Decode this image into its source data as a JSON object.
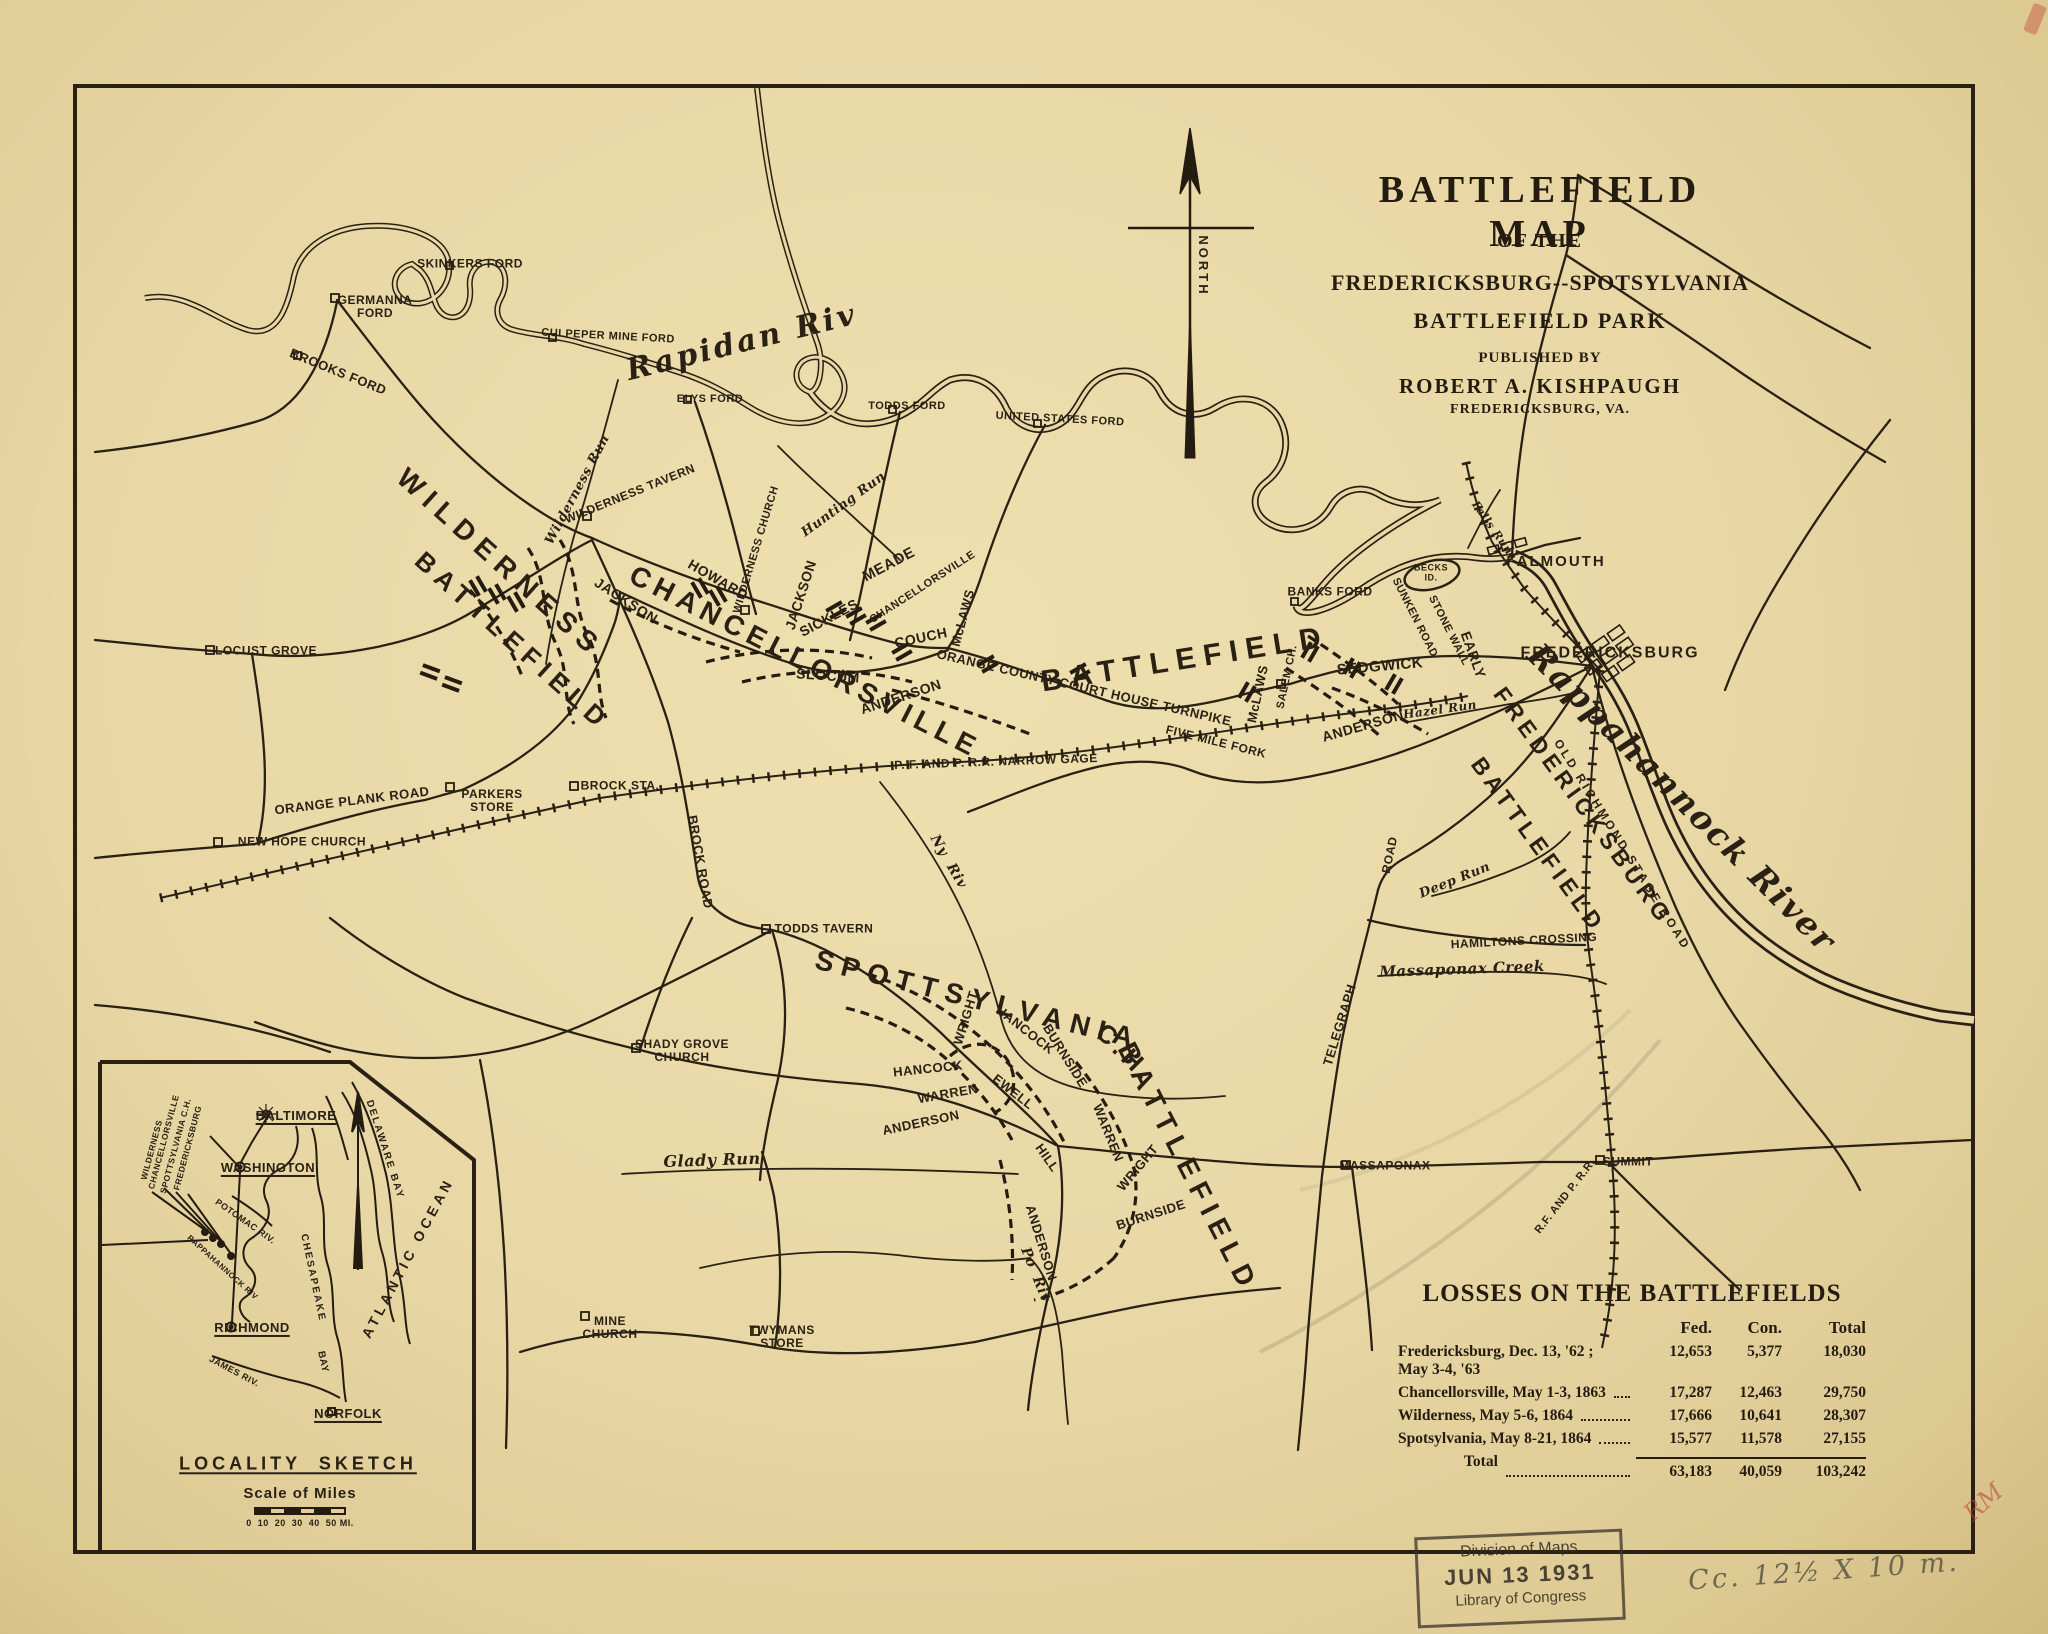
{
  "title_block": {
    "line1": "BATTLEFIELD MAP",
    "line2": "OF THE",
    "line3": "FREDERICKSBURG--SPOTSYLVANIA",
    "line4": "BATTLEFIELD PARK",
    "published_by": "PUBLISHED BY",
    "publisher": "ROBERT A. KISHPAUGH",
    "publisher_city": "FREDERICKSBURG, VA."
  },
  "north_arrow": {
    "label": "NORTH"
  },
  "losses_table": {
    "title": "LOSSES ON THE BATTLEFIELDS",
    "columns": [
      "Fed.",
      "Con.",
      "Total"
    ],
    "rows": [
      {
        "name": "Fredericksburg, Dec. 13, '62 ; May 3-4, '63",
        "fed": "12,653",
        "con": "5,377",
        "total": "18,030"
      },
      {
        "name": "Chancellorsville, May 1-3, 1863",
        "fed": "17,287",
        "con": "12,463",
        "total": "29,750"
      },
      {
        "name": "Wilderness, May 5-6, 1864",
        "fed": "17,666",
        "con": "10,641",
        "total": "28,307"
      },
      {
        "name": "Spotsylvania, May 8-21, 1864",
        "fed": "15,577",
        "con": "11,578",
        "total": "27,155"
      }
    ],
    "total_row": {
      "name": "Total",
      "fed": "63,183",
      "con": "40,059",
      "total": "103,242"
    }
  },
  "stamp": {
    "line1": "Division of Maps",
    "line2": "JUN 13 1931",
    "line3": "Library of Congress"
  },
  "annotations": {
    "pencil_note": "Cc. 12½ X 10 m.",
    "red_mark": "RM"
  },
  "colors": {
    "ink": "#2a2114",
    "paper": "#e9d8a6",
    "stamp": "#38322866",
    "pencil": "#6e6750",
    "red": "#b93e32"
  },
  "map_labels": [
    {
      "t": "SKINKERS FORD",
      "x": 470,
      "y": 264,
      "r": 0,
      "c": "pl",
      "fs": 12,
      "n": "label-skinkers-ford"
    },
    {
      "t": "GERMANNA\nFORD",
      "x": 375,
      "y": 307,
      "r": 0,
      "c": "pl",
      "fs": 12,
      "n": "label-germanna-ford"
    },
    {
      "t": "BROOKS FORD",
      "x": 338,
      "y": 372,
      "r": 22,
      "c": "pl",
      "fs": 13,
      "n": "label-brooks-ford"
    },
    {
      "t": "CULPEPER MINE FORD",
      "x": 608,
      "y": 337,
      "r": 3,
      "c": "pl",
      "fs": 11,
      "n": "label-culpeper-mine-ford"
    },
    {
      "t": "ELYS FORD",
      "x": 710,
      "y": 400,
      "r": 0,
      "c": "pl",
      "fs": 11,
      "n": "label-elys-ford"
    },
    {
      "t": "TODDS FORD",
      "x": 907,
      "y": 407,
      "r": 0,
      "c": "pl",
      "fs": 11,
      "n": "label-todds-ford"
    },
    {
      "t": "UNITED STATES FORD",
      "x": 1060,
      "y": 420,
      "r": 3,
      "c": "pl",
      "fs": 11,
      "n": "label-united-states-ford"
    },
    {
      "t": "BANKS FORD",
      "x": 1330,
      "y": 592,
      "r": 0,
      "c": "pl",
      "fs": 12,
      "n": "label-banks-ford"
    },
    {
      "t": "Rapidan Riv",
      "x": 742,
      "y": 343,
      "r": -14,
      "c": "scr",
      "fs": 30,
      "ls": 3,
      "n": "label-rapidan-river"
    },
    {
      "t": "Rappahannock River",
      "x": 1682,
      "y": 798,
      "r": 45,
      "c": "scr",
      "fs": 33,
      "ls": 2,
      "n": "label-rappahannock-river"
    },
    {
      "t": "Wilderness Run",
      "x": 578,
      "y": 490,
      "r": -62,
      "c": "scr",
      "fs": 13,
      "n": "label-wilderness-run"
    },
    {
      "t": "Hunting Run",
      "x": 844,
      "y": 505,
      "r": -36,
      "c": "scr",
      "fs": 13,
      "n": "label-hunting-run"
    },
    {
      "t": "Falls Run",
      "x": 1492,
      "y": 528,
      "r": 55,
      "c": "scr",
      "fs": 11,
      "n": "label-falls-run"
    },
    {
      "t": "Ny  Riv",
      "x": 948,
      "y": 862,
      "r": 60,
      "c": "scr",
      "fs": 14,
      "n": "label-ny-river"
    },
    {
      "t": "Po  Riv",
      "x": 1035,
      "y": 1275,
      "r": 68,
      "c": "scr",
      "fs": 14,
      "n": "label-po-river"
    },
    {
      "t": "Glady Run",
      "x": 712,
      "y": 1160,
      "r": -2,
      "c": "scr",
      "fs": 16,
      "n": "label-glady-run"
    },
    {
      "t": "Massaponax Creek",
      "x": 1462,
      "y": 969,
      "r": -2,
      "c": "scr",
      "fs": 15,
      "n": "label-massaponax-creek"
    },
    {
      "t": "Deep Run",
      "x": 1455,
      "y": 881,
      "r": -22,
      "c": "scr",
      "fs": 13,
      "n": "label-deep-run"
    },
    {
      "t": "Hazel Run",
      "x": 1440,
      "y": 710,
      "r": -8,
      "c": "scr",
      "fs": 12,
      "n": "label-hazel-run"
    },
    {
      "t": "WILDERNESS",
      "x": 500,
      "y": 563,
      "r": 42,
      "c": "big",
      "fs": 28,
      "ls": 8,
      "n": "label-wilderness-battlefield-1"
    },
    {
      "t": "BATTLEFIELD",
      "x": 513,
      "y": 641,
      "r": 42,
      "c": "big",
      "fs": 26,
      "ls": 7,
      "n": "label-wilderness-battlefield-2"
    },
    {
      "t": "CHANCELLORSVILLE",
      "x": 805,
      "y": 662,
      "r": 27,
      "c": "big",
      "fs": 28,
      "ls": 6,
      "n": "label-chancellorsville-big"
    },
    {
      "t": "BATTLEFIELD",
      "x": 1185,
      "y": 660,
      "r": -9,
      "c": "big",
      "fs": 30,
      "ls": 8,
      "n": "label-chancellorsville-battlefield"
    },
    {
      "t": "FREDERICKSBURG",
      "x": 1583,
      "y": 806,
      "r": 54,
      "c": "big",
      "fs": 23,
      "ls": 5,
      "n": "label-fredericksburg-battlefield-1"
    },
    {
      "t": "BATTLEFIELD",
      "x": 1538,
      "y": 845,
      "r": 54,
      "c": "big",
      "fs": 23,
      "ls": 5,
      "n": "label-fredericksburg-battlefield-2"
    },
    {
      "t": "SPOTTSYLVANIA",
      "x": 978,
      "y": 1000,
      "r": 14,
      "c": "big",
      "fs": 28,
      "ls": 8,
      "n": "label-spotsylvania-big"
    },
    {
      "t": "C.H.",
      "x": 1126,
      "y": 1053,
      "r": 45,
      "c": "big",
      "fs": 26,
      "ls": 5,
      "n": "label-spotsylvania-ch"
    },
    {
      "t": "BATTLEFIELD",
      "x": 1188,
      "y": 1168,
      "r": 63,
      "c": "big",
      "fs": 28,
      "ls": 8,
      "n": "label-spotsylvania-battlefield"
    },
    {
      "t": "LOCUST GROVE",
      "x": 266,
      "y": 651,
      "r": 0,
      "c": "pl",
      "fs": 12,
      "n": "label-locust-grove"
    },
    {
      "t": "NEW HOPE CHURCH",
      "x": 302,
      "y": 842,
      "r": 0,
      "c": "pl",
      "fs": 12,
      "n": "label-new-hope-church"
    },
    {
      "t": "ORANGE PLANK ROAD",
      "x": 352,
      "y": 801,
      "r": -7,
      "c": "pl",
      "fs": 13,
      "n": "label-orange-plank-road"
    },
    {
      "t": "PARKERS\nSTORE",
      "x": 492,
      "y": 801,
      "r": 0,
      "c": "pl",
      "fs": 12,
      "n": "label-parkers-store"
    },
    {
      "t": "BROCK STA.",
      "x": 620,
      "y": 786,
      "r": 0,
      "c": "pl",
      "fs": 12,
      "n": "label-brock-station"
    },
    {
      "t": "BROCK ROAD",
      "x": 700,
      "y": 862,
      "r": 80,
      "c": "pl",
      "fs": 13,
      "n": "label-brock-road"
    },
    {
      "t": "TODDS TAVERN",
      "x": 824,
      "y": 929,
      "r": 0,
      "c": "pl",
      "fs": 12,
      "n": "label-todds-tavern"
    },
    {
      "t": "WILDERNESS TAVERN",
      "x": 630,
      "y": 494,
      "r": -22,
      "c": "pl",
      "fs": 12,
      "n": "label-wilderness-tavern"
    },
    {
      "t": "WILDERNESS CHURCH",
      "x": 757,
      "y": 550,
      "r": -73,
      "c": "pl",
      "fs": 11,
      "n": "label-wilderness-church"
    },
    {
      "t": "SHADY GROVE\nCHURCH",
      "x": 682,
      "y": 1051,
      "r": 0,
      "c": "pl",
      "fs": 12,
      "n": "label-shady-grove-church"
    },
    {
      "t": "MINE\nCHURCH",
      "x": 610,
      "y": 1328,
      "r": 0,
      "c": "pl",
      "fs": 12,
      "n": "label-mine-church"
    },
    {
      "t": "TWYMANS\nSTORE",
      "x": 782,
      "y": 1337,
      "r": 0,
      "c": "pl",
      "fs": 12,
      "n": "label-twymans-store"
    },
    {
      "t": "MASSAPONAX",
      "x": 1385,
      "y": 1166,
      "r": 0,
      "c": "pl",
      "fs": 12,
      "n": "label-massaponax"
    },
    {
      "t": "SUMMIT",
      "x": 1628,
      "y": 1162,
      "r": 0,
      "c": "pl",
      "fs": 12,
      "n": "label-summit"
    },
    {
      "t": "FALMOUTH",
      "x": 1556,
      "y": 562,
      "r": 0,
      "c": "pl",
      "fs": 15,
      "ls": 2,
      "n": "label-falmouth"
    },
    {
      "t": "FREDERICKSBURG",
      "x": 1610,
      "y": 653,
      "r": 0,
      "c": "pl",
      "fs": 16,
      "ls": 2,
      "n": "label-fredericksburg-city"
    },
    {
      "t": "BECKS\nID.",
      "x": 1431,
      "y": 573,
      "r": 0,
      "c": "pl",
      "fs": 9,
      "n": "label-becks-island"
    },
    {
      "t": "SALEM CH.",
      "x": 1288,
      "y": 677,
      "r": -78,
      "c": "pl",
      "fs": 11,
      "n": "label-salem-church"
    },
    {
      "t": "HAMILTONS CROSSING",
      "x": 1524,
      "y": 941,
      "r": -3,
      "c": "pl",
      "fs": 12,
      "n": "label-hamiltons-crossing"
    },
    {
      "t": "FIVE MILE FORK",
      "x": 1216,
      "y": 742,
      "r": 14,
      "c": "pl",
      "fs": 12,
      "n": "label-five-mile-fork"
    },
    {
      "t": "P. F. AND P. R.R. NARROW GAGE",
      "x": 996,
      "y": 762,
      "r": -2,
      "c": "pl",
      "fs": 12,
      "n": "label-pf-prr-narrow-gage"
    },
    {
      "t": "ORANGE COUNTY COURT HOUSE TURNPIKE",
      "x": 1084,
      "y": 688,
      "r": 13,
      "c": "pl",
      "fs": 13,
      "n": "label-orange-county-courthouse-turnpike"
    },
    {
      "t": "TELEGRAPH",
      "x": 1340,
      "y": 1025,
      "r": -73,
      "c": "pl",
      "fs": 13,
      "n": "label-telegraph-road-1"
    },
    {
      "t": "ROAD",
      "x": 1390,
      "y": 855,
      "r": -78,
      "c": "pl",
      "fs": 12,
      "n": "label-telegraph-road-2"
    },
    {
      "t": "OLD RICHMOND STAGE ROAD",
      "x": 1622,
      "y": 845,
      "r": 58,
      "c": "pl",
      "fs": 12,
      "ls": 3,
      "n": "label-old-richmond-stage-road"
    },
    {
      "t": "R.F. AND P. R.R.",
      "x": 1566,
      "y": 1197,
      "r": -52,
      "c": "pl",
      "fs": 11,
      "n": "label-rf-and-p-rr"
    },
    {
      "t": "SUNKEN ROAD",
      "x": 1414,
      "y": 618,
      "r": 63,
      "c": "pl",
      "fs": 11,
      "n": "label-sunken-road"
    },
    {
      "t": "STONE WALL",
      "x": 1448,
      "y": 631,
      "r": 63,
      "c": "pl",
      "fs": 11,
      "n": "label-stone-wall"
    },
    {
      "t": "HOWARD",
      "x": 718,
      "y": 580,
      "r": 30,
      "c": "cmd",
      "fs": 14,
      "n": "label-howard"
    },
    {
      "t": "JACKSON",
      "x": 626,
      "y": 601,
      "r": 33,
      "c": "cmd",
      "fs": 14,
      "n": "label-jackson-west"
    },
    {
      "t": "JACKSON",
      "x": 801,
      "y": 595,
      "r": -72,
      "c": "cmd",
      "fs": 14,
      "n": "label-jackson-church"
    },
    {
      "t": "SICKLES",
      "x": 829,
      "y": 618,
      "r": -28,
      "c": "cmd",
      "fs": 14,
      "n": "label-sickles"
    },
    {
      "t": "MEADE",
      "x": 889,
      "y": 565,
      "r": -28,
      "c": "cmd",
      "fs": 15,
      "n": "label-meade"
    },
    {
      "t": "CHANCELLORSVILLE",
      "x": 923,
      "y": 588,
      "r": -33,
      "c": "pl",
      "fs": 11,
      "n": "label-chancellorsville-place"
    },
    {
      "t": "COUCH",
      "x": 921,
      "y": 638,
      "r": -12,
      "c": "cmd",
      "fs": 14,
      "n": "label-couch"
    },
    {
      "t": "McLAWS",
      "x": 963,
      "y": 618,
      "r": -75,
      "c": "cmd",
      "fs": 13,
      "n": "label-mclaws-chancellorsville"
    },
    {
      "t": "SLOCUM",
      "x": 828,
      "y": 676,
      "r": 4,
      "c": "cmd",
      "fs": 14,
      "n": "label-slocum"
    },
    {
      "t": "ANDERSON",
      "x": 901,
      "y": 697,
      "r": -18,
      "c": "cmd",
      "fs": 14,
      "n": "label-anderson-chancellorsville"
    },
    {
      "t": "SEDGWICK",
      "x": 1380,
      "y": 667,
      "r": -5,
      "c": "cmd",
      "fs": 15,
      "n": "label-sedgwick"
    },
    {
      "t": "EARLY",
      "x": 1473,
      "y": 655,
      "r": 70,
      "c": "cmd",
      "fs": 14,
      "n": "label-early"
    },
    {
      "t": "ANDERSON",
      "x": 1363,
      "y": 726,
      "r": -16,
      "c": "cmd",
      "fs": 14,
      "n": "label-anderson-fredericksburg"
    },
    {
      "t": "McLAWS",
      "x": 1258,
      "y": 694,
      "r": -78,
      "c": "cmd",
      "fs": 13,
      "n": "label-mclaws-fredericksburg"
    },
    {
      "t": "WRIGHT",
      "x": 966,
      "y": 1018,
      "r": -73,
      "c": "cmd",
      "fs": 13,
      "n": "label-wright-west"
    },
    {
      "t": "HANCOCK",
      "x": 1025,
      "y": 1030,
      "r": 38,
      "c": "cmd",
      "fs": 13,
      "n": "label-hancock-salient"
    },
    {
      "t": "BURNSIDE",
      "x": 1065,
      "y": 1056,
      "r": 58,
      "c": "cmd",
      "fs": 13,
      "n": "label-burnside-salient"
    },
    {
      "t": "HANCOCK",
      "x": 928,
      "y": 1069,
      "r": -6,
      "c": "cmd",
      "fs": 13,
      "n": "label-hancock-west"
    },
    {
      "t": "WARREN",
      "x": 948,
      "y": 1094,
      "r": -10,
      "c": "cmd",
      "fs": 13,
      "n": "label-warren-west"
    },
    {
      "t": "EWELL",
      "x": 1013,
      "y": 1092,
      "r": 38,
      "c": "cmd",
      "fs": 13,
      "n": "label-ewell"
    },
    {
      "t": "ANDERSON",
      "x": 921,
      "y": 1123,
      "r": -12,
      "c": "cmd",
      "fs": 13,
      "n": "label-anderson-spotsylvania-west"
    },
    {
      "t": "HILL",
      "x": 1047,
      "y": 1158,
      "r": 55,
      "c": "cmd",
      "fs": 13,
      "n": "label-hill"
    },
    {
      "t": "WARREN",
      "x": 1108,
      "y": 1133,
      "r": 68,
      "c": "cmd",
      "fs": 13,
      "n": "label-warren-east"
    },
    {
      "t": "WRIGHT",
      "x": 1138,
      "y": 1168,
      "r": -50,
      "c": "cmd",
      "fs": 13,
      "n": "label-wright-east"
    },
    {
      "t": "BURNSIDE",
      "x": 1151,
      "y": 1215,
      "r": -18,
      "c": "cmd",
      "fs": 13,
      "n": "label-burnside-south"
    },
    {
      "t": "ANDERSON",
      "x": 1041,
      "y": 1243,
      "r": 73,
      "c": "cmd",
      "fs": 13,
      "n": "label-anderson-spotsylvania-south"
    },
    {
      "t": "NORTH",
      "x": 1203,
      "y": 266,
      "r": 90,
      "c": "pl",
      "fs": 13,
      "ls": 3,
      "n": "label-north"
    }
  ],
  "inset_labels": [
    {
      "t": "BALTIMORE",
      "x": 296,
      "y": 1116,
      "r": 0,
      "c": "pl u",
      "fs": 13,
      "n": "inset-label-baltimore"
    },
    {
      "t": "WASHINGTON",
      "x": 268,
      "y": 1168,
      "r": 0,
      "c": "pl u",
      "fs": 13,
      "n": "inset-label-washington"
    },
    {
      "t": "RICHMOND",
      "x": 252,
      "y": 1328,
      "r": 0,
      "c": "pl u",
      "fs": 13,
      "n": "inset-label-richmond"
    },
    {
      "t": "NORFOLK",
      "x": 348,
      "y": 1414,
      "r": 0,
      "c": "pl u",
      "fs": 13,
      "n": "inset-label-norfolk"
    },
    {
      "t": "WILDERNESS",
      "x": 152,
      "y": 1150,
      "r": -75,
      "c": "pl",
      "fs": 8.5,
      "n": "inset-label-wilderness"
    },
    {
      "t": "CHANCELLORSVILLE",
      "x": 164,
      "y": 1142,
      "r": -75,
      "c": "pl",
      "fs": 8.5,
      "n": "inset-label-chancellorsville"
    },
    {
      "t": "SPOTTSYLVANIA C.H.",
      "x": 176,
      "y": 1146,
      "r": -75,
      "c": "pl",
      "fs": 8.5,
      "n": "inset-label-spotsylvania-ch"
    },
    {
      "t": "FREDERICKSBURG",
      "x": 188,
      "y": 1148,
      "r": -75,
      "c": "pl",
      "fs": 8.5,
      "n": "inset-label-fredericksburg"
    },
    {
      "t": "DELAWARE BAY",
      "x": 384,
      "y": 1150,
      "r": 72,
      "c": "pl",
      "fs": 10,
      "ls": 2,
      "n": "inset-label-delaware-bay"
    },
    {
      "t": "ATLANTIC OCEAN",
      "x": 408,
      "y": 1258,
      "r": -62,
      "c": "pl",
      "fs": 14,
      "ls": 4,
      "n": "inset-label-atlantic-ocean"
    },
    {
      "t": "CHESAPEAKE",
      "x": 312,
      "y": 1278,
      "r": 78,
      "c": "pl",
      "fs": 10,
      "ls": 2,
      "n": "inset-label-chesapeake"
    },
    {
      "t": "BAY",
      "x": 322,
      "y": 1362,
      "r": 78,
      "c": "pl",
      "fs": 10,
      "n": "inset-label-chesapeake-bay"
    },
    {
      "t": "POTOMAC RIV.",
      "x": 245,
      "y": 1222,
      "r": 35,
      "c": "pl",
      "fs": 9,
      "n": "inset-label-potomac-riv"
    },
    {
      "t": "RAPPAHANNOCK RIV",
      "x": 222,
      "y": 1268,
      "r": 42,
      "c": "pl",
      "fs": 8,
      "n": "inset-label-rappahannock-riv"
    },
    {
      "t": "JAMES RIV.",
      "x": 234,
      "y": 1372,
      "r": 28,
      "c": "pl",
      "fs": 9,
      "n": "inset-label-james-riv"
    },
    {
      "t": "LOCALITY  SKETCH",
      "x": 298,
      "y": 1464,
      "r": 0,
      "c": "pl u",
      "fs": 18,
      "ls": 4,
      "n": "inset-label-locality-sketch"
    },
    {
      "t": "Scale of Miles",
      "x": 300,
      "y": 1494,
      "r": 0,
      "c": "pl",
      "fs": 15,
      "ls": 1,
      "n": "inset-label-scale-of-miles"
    },
    {
      "t": "0  10  20  30  40  50 MI.",
      "x": 300,
      "y": 1524,
      "r": 0,
      "c": "pl",
      "fs": 9,
      "n": "inset-label-scale-numbers"
    }
  ]
}
